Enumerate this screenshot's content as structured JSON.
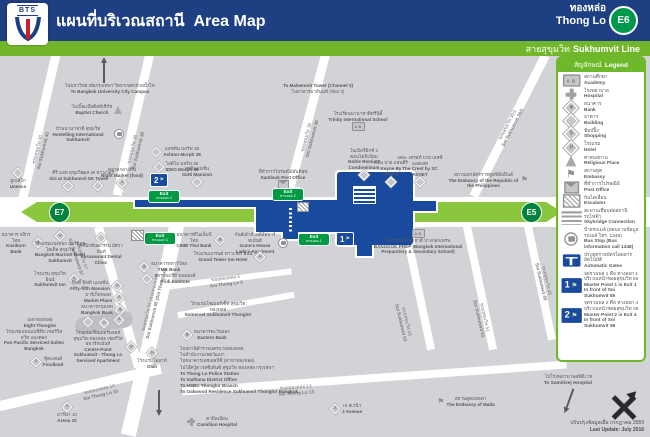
{
  "header": {
    "logo": "BTS",
    "title_th": "แผนที่บริเวณสถานี",
    "title_en": "Area Map",
    "station_th": "ทองหล่อ",
    "station_en": "Thong Lo",
    "code": "E6",
    "line_th": "สายสุขุมวิท",
    "line_en": "Sukhumvit Line"
  },
  "colors": {
    "navy": "#1e3f82",
    "green": "#72b62c",
    "road_green": "#8bc63f",
    "station_blue": "#1a4a9e",
    "exit_green": "#009a44"
  },
  "map": {
    "road": {
      "th": "ถนนสุขุมวิท",
      "en": "Sukhumvit Rd.",
      "left": "E7",
      "right": "E5"
    },
    "exit_word_en": "Exit",
    "exit_word_th": "ทางออก",
    "exits": [
      {
        "n": "1",
        "x": 298,
        "y": 233
      },
      {
        "n": "2",
        "x": 272,
        "y": 188
      },
      {
        "n": "3",
        "x": 144,
        "y": 232
      },
      {
        "n": "4",
        "x": 148,
        "y": 190
      }
    ],
    "musters": [
      {
        "n": "1",
        "x": 336,
        "y": 232
      },
      {
        "n": "2",
        "x": 150,
        "y": 173
      }
    ],
    "places": [
      {
        "x": 110,
        "y": 83,
        "w": 104,
        "icon": "",
        "ipos": "",
        "th": "ไปมหาวิทยาลัยกรุงเทพฯ วิทยาเขตกล้วยน้ำไท",
        "en": "To Bangkok University City Campus"
      },
      {
        "x": 318,
        "y": 83,
        "w": 112,
        "icon": "",
        "ipos": "",
        "ef": true,
        "th": "ไปอาคารมาลีนนท์ (ช่อง 3)",
        "en": "To Maleenont Tower (Channel 3)"
      },
      {
        "x": 97,
        "y": 104,
        "w": 74,
        "icon": "religious",
        "ipos": "r",
        "th": "ไบเบิ้ลแบ๊พติสท์เชิร์ช",
        "en": "Baptist Church"
      },
      {
        "x": 84,
        "y": 126,
        "w": 80,
        "icon": "busstop",
        "ipos": "r",
        "th": "บ้านนานาชาติ สุขุมวิท",
        "en": "Hostelling International Sukhumvit"
      },
      {
        "x": 122,
        "y": 167,
        "w": 56,
        "icon": "shopping",
        "ipos": "b",
        "th": "ตลาดกลางคืน",
        "en": "Night Market (food)"
      },
      {
        "x": 176,
        "y": 146,
        "w": 64,
        "icon": "building",
        "ipos": "l",
        "th": "แอชตัน มอร์ฟ 38",
        "en": "Ashton Morph 38"
      },
      {
        "x": 176,
        "y": 161,
        "w": 64,
        "icon": "building",
        "ipos": "l",
        "th": "ไอดีโอ มอร์ฟ 38",
        "en": "IDEO Morph 38"
      },
      {
        "x": 197,
        "y": 166,
        "w": 52,
        "icon": "building",
        "ipos": "b",
        "th": "สุทธิแมนชั่น",
        "en": "Sutti Mansion"
      },
      {
        "x": 18,
        "y": 168,
        "w": 42,
        "icon": "building",
        "ipos": "t",
        "th": "ยูเนสโก",
        "en": "Unesco"
      },
      {
        "x": 68,
        "y": 170,
        "w": 46,
        "icon": "building",
        "ipos": "b",
        "th": "ศิริ แอท สุขุมวิท",
        "en": "Siri at Sukhumvit"
      },
      {
        "x": 98,
        "y": 170,
        "w": 38,
        "icon": "building",
        "ipos": "b",
        "th": "เอส เค ทาวเวอร์",
        "en": "SK Tower"
      },
      {
        "x": 283,
        "y": 169,
        "w": 68,
        "icon": "post",
        "ipos": "b",
        "th": "ที่ทำการไปรษณีย์สันติสุข",
        "en": "Santisuk Post Office"
      },
      {
        "x": 364,
        "y": 148,
        "w": 50,
        "icon": "building",
        "ipos": "b",
        "th": "โนเบิลรีมิกซ์ 2 คอนโดมิเนียม",
        "en": "Noble Remix 2 Condominium"
      },
      {
        "x": 391,
        "y": 160,
        "w": 36,
        "icon": "building",
        "ipos": "b",
        "th": "คีย์น บาย แสนสิริ",
        "en": "Keyne By Sansiri"
      },
      {
        "x": 420,
        "y": 155,
        "w": 46,
        "icon": "building",
        "ipos": "b",
        "th": "เดอะ เครสท์ บาย เอสซี แอสเสท",
        "en": "The Crest by SC ASSET"
      },
      {
        "x": 358,
        "y": 111,
        "w": 84,
        "icon": "academy",
        "ipos": "b",
        "th": "โรงเรียนนานาชาติทรินิตี้",
        "en": "Trinity International School"
      },
      {
        "x": 488,
        "y": 172,
        "w": 80,
        "icon": "embassy",
        "ipos": "r",
        "th": "สถานเอกอัครราชทูตฟิลิปปินส์",
        "en": "The Embassy of the Republic of the Philippines"
      },
      {
        "x": 22,
        "y": 232,
        "w": 42,
        "icon": "bank",
        "ipos": "r",
        "th": "ธนาคาร กสิกรไทย",
        "en": "Kasikorn Bank"
      },
      {
        "x": 60,
        "y": 231,
        "w": 54,
        "icon": "hotel",
        "ipos": "t",
        "th": "โรงแรมแบงค็อก แมริออท โฮเต็ล สุขุมวิท",
        "en": "Bangkok Marriott Hotel Sukhumvit"
      },
      {
        "x": 101,
        "y": 233,
        "w": 50,
        "icon": "building",
        "ipos": "t",
        "th": "คลินิกทันตกรรม อัศวานันท์",
        "en": "Assavanant Dental Clinic"
      },
      {
        "x": 200,
        "y": 232,
        "w": 50,
        "icon": "bank",
        "ipos": "r",
        "th": "ธนาคารซีไอเอ็มบี ไทย",
        "en": "CIMB Thai Bank"
      },
      {
        "x": 261,
        "y": 232,
        "w": 54,
        "icon": "busstop",
        "ipos": "r",
        "th": "กันส์เฮ้าส์ เลดี้ส์อพาร์ทเม้นท์",
        "en": "Gunn's House Lady's Apartment"
      },
      {
        "x": 229,
        "y": 251,
        "w": 84,
        "icon": "hotel",
        "ipos": "r",
        "th": "โรงแรมแกรนด์ ทาวเวอร์ อินน์",
        "en": "Grand Tower Inn Hotel"
      },
      {
        "x": 163,
        "y": 261,
        "w": 52,
        "icon": "bank",
        "ipos": "l",
        "th": "ธนาคารทหารไทย",
        "en": "TMB Bank"
      },
      {
        "x": 169,
        "y": 273,
        "w": 58,
        "icon": "building",
        "ipos": "l",
        "th": "สถาบันปรีดี พนมยงค์",
        "en": "Pridi Institute"
      },
      {
        "x": 56,
        "y": 271,
        "w": 46,
        "icon": "hotel",
        "ipos": "r",
        "th": "โรงแรม สุขุมวิท อินน์",
        "en": "Sukhumvit Inn"
      },
      {
        "x": 96,
        "y": 280,
        "w": 56,
        "icon": "hotel",
        "ipos": "r",
        "th": "ฟิฟตี้ ฟิฟท์ แมนชั่น",
        "en": "Fifty-fifth Mansion"
      },
      {
        "x": 104,
        "y": 292,
        "w": 46,
        "icon": "shopping",
        "ipos": "r",
        "th": "มาร์เก็ตเพลส",
        "en": "Market Place"
      },
      {
        "x": 103,
        "y": 304,
        "w": 46,
        "icon": "bank",
        "ipos": "r",
        "th": "ธนาคารกรุงเทพ",
        "en": "Bangkok Bank"
      },
      {
        "x": 40,
        "y": 317,
        "w": 48,
        "icon": "",
        "ipos": "",
        "th": "เอท ทองหล่อ",
        "en": "Eight Thonglor"
      },
      {
        "x": 34,
        "y": 329,
        "w": 64,
        "icon": "",
        "ipos": "",
        "th": "โรงแรมแพนแปซิฟิก เซอร์วิส สวีท แบงคอก",
        "en": "Pan Pacific Serviced Suites Bangkok"
      },
      {
        "x": 47,
        "y": 356,
        "w": 42,
        "icon": "shopping",
        "ipos": "l",
        "th": "ฟู้ดแลนด์",
        "en": "Foodland"
      },
      {
        "x": 104,
        "y": 330,
        "w": 64,
        "icon": "hotel",
        "ipos": "r",
        "th": "โรงแรมเซ็นเตอร์พอยท์ สุขุมวิท-ทองหล่อ เซอร์วิส อพาร์ทเม้นท์",
        "en": "Centre Point Sukhumvit - Thong Lo Serviced Apartment"
      },
      {
        "x": 152,
        "y": 348,
        "w": 42,
        "icon": "hotel",
        "ipos": "t",
        "th": "โรงแรมโอลาห์",
        "en": "Olah"
      },
      {
        "x": 218,
        "y": 301,
        "w": 70,
        "icon": "",
        "ipos": "",
        "th": "โรงแรมโซเมอร์เซ็ท สุขุมวิท ทองหล่อ",
        "en": "Somerset Sukhumvit Thonglor"
      },
      {
        "x": 206,
        "y": 329,
        "w": 58,
        "icon": "bank",
        "ipos": "l",
        "th": "ธนาคารตะวันออก",
        "en": "Eastern Bank"
      },
      {
        "x": 418,
        "y": 229,
        "w": 112,
        "icon": "academy",
        "ipos": "t",
        "th": "โรงเรียนนานาชาติ บางกอกเพรพ",
        "en": "BANGKOK PREP (Bangkok International Preparatory & Secondary School)"
      },
      {
        "x": 346,
        "y": 403,
        "w": 42,
        "icon": "shopping",
        "ipos": "l",
        "th": "เจ อเวนิว",
        "en": "J Avenue"
      },
      {
        "x": 212,
        "y": 416,
        "w": 52,
        "icon": "hospital",
        "ipos": "l",
        "th": "คามิลเลี่ยน",
        "en": "Camillian Hospital"
      },
      {
        "x": 67,
        "y": 402,
        "w": 38,
        "icon": "shopping",
        "ipos": "t",
        "th": "อารีน่า 10",
        "en": "Arena 10"
      },
      {
        "x": 466,
        "y": 396,
        "w": 64,
        "icon": "embassy",
        "ipos": "l",
        "th": "สถานทูตมอลตา",
        "en": "The Embassy of Malta"
      },
      {
        "x": 88,
        "y": 317,
        "w": 8,
        "icon": "building",
        "ipos": "only",
        "th": "",
        "en": ""
      },
      {
        "x": 104,
        "y": 318,
        "w": 8,
        "icon": "hotel",
        "ipos": "only",
        "th": "",
        "en": ""
      },
      {
        "x": 119,
        "y": 315,
        "w": 8,
        "icon": "shopping",
        "ipos": "only",
        "th": "",
        "en": ""
      }
    ],
    "streets": [
      {
        "x": 40,
        "y": 150,
        "rot": -76,
        "th": "ซอยสุขุมวิท 40",
        "en": "Soi Sukhumvit 40"
      },
      {
        "x": 135,
        "y": 150,
        "rot": -76,
        "th": "ซอยสุขุมวิท 38",
        "en": "Soi Sukhumvit 38"
      },
      {
        "x": 309,
        "y": 138,
        "rot": -75,
        "th": "ซอยสุขุมวิท 36",
        "en": "Soi Sukhumvit 36"
      },
      {
        "x": 510,
        "y": 126,
        "rot": -62,
        "th": "ซอยสุขุมวิท 30/1",
        "en": "Soi Sukhumvit 30/1"
      },
      {
        "x": 79,
        "y": 256,
        "rot": 72,
        "th": "ซอยสุขุมวิท 57",
        "en": "Soi Sukhumvit 57"
      },
      {
        "x": 153,
        "y": 303,
        "rot": -76,
        "th": "ซอยสุขุมวิท 55 (ซอยทองหล่อ)",
        "en": "Soi Sukhumvit 55 (Soi Thong Lo)"
      },
      {
        "x": 226,
        "y": 281,
        "rot": -7,
        "th": "ซอยทองหล่อ 5",
        "en": "Soi Thong Lo 5"
      },
      {
        "x": 100,
        "y": 392,
        "rot": -13,
        "th": "ซอยทองหล่อ 10",
        "en": "Soi Thong Lo 10"
      },
      {
        "x": 296,
        "y": 390,
        "rot": -4,
        "th": "ซอยทองหล่อ 13",
        "en": "Soi Thong Lo 13"
      },
      {
        "x": 404,
        "y": 322,
        "rot": 77,
        "th": "ซอยสุขุมวิท 53",
        "en": "Soi Sukhumvit 53"
      },
      {
        "x": 482,
        "y": 318,
        "rot": 77,
        "th": "ซอยสุขุมวิท 51",
        "en": "Soi Sukhumvit 51"
      },
      {
        "x": 544,
        "y": 281,
        "rot": 77,
        "th": "ซอยสุขุมวิท 49",
        "en": "Soi Sukhumvit 49"
      }
    ],
    "directions": {
      "th": [
        "ไปสถานีตำรวจนครบาลทองหล่อ",
        "ไปสำนักงานเขตวัฒนา",
        "ไปธนาคารเอชเอสบีซี (สาขาทองหล่อ)",
        "ไปโอ๊ควู้ด เรสซิเด้นซ์ สุขุมวิท ทองหล่อ กรุงเทพฯ"
      ],
      "en": [
        "To Thong Lo Police Station",
        "To Vadhana District Office",
        "To HSBC Thonglor Branch",
        "To Oakwood Residence Sukhumvit Thonglor Bangkok"
      ]
    }
  },
  "legend": {
    "title_th": "สัญลักษณ์",
    "title_en": "Legend",
    "items": [
      {
        "icon": "academy",
        "th": "สถานศึกษา",
        "en": "Academy"
      },
      {
        "icon": "hospital",
        "th": "โรงพยาบาล",
        "en": "Hospital"
      },
      {
        "icon": "bank",
        "th": "ธนาคาร",
        "en": "Bank"
      },
      {
        "icon": "building",
        "th": "อาคาร",
        "en": "Building"
      },
      {
        "icon": "shopping",
        "th": "ช้อปปิ้ง",
        "en": "Shopping"
      },
      {
        "icon": "hotel",
        "th": "โรงแรม",
        "en": "Hotel"
      },
      {
        "icon": "religious",
        "th": "ศาสนสถาน",
        "en": "Religious Place"
      },
      {
        "icon": "embassy",
        "th": "สถานทูต",
        "en": "Embassy"
      },
      {
        "icon": "post",
        "th": "ที่ทำการไปรษณีย์",
        "en": "Post Office"
      },
      {
        "icon": "escalator",
        "th": "บันไดเลื่อน",
        "en": "Escalator"
      },
      {
        "icon": "skybridge",
        "th": "สะพานเชื่อมต่อสถานีรถไฟฟ้า",
        "en": "Skybridge Connection"
      },
      {
        "icon": "busstop",
        "th": "ป้ายรถเมล์ (สอบถามข้อมูลรถเมล์ โทร. 1348)",
        "en": "Bus Stop (Bus information call 1348)"
      },
      {
        "icon": "gates",
        "th": "ประตูตรวจบัตรโดยสารอัตโนมัติ",
        "en": "Automatic Gates"
      },
      {
        "icon": "muster",
        "num": "1",
        "th": "จุดรวมพล 1 คือ ทางออก 1 บริเวณหน้าซอยสุขุมวิท 55",
        "en": "Muster Point 1 is Exit 1 In front of Soi Sukhumvit 55"
      },
      {
        "icon": "muster",
        "num": "2",
        "th": "จุดรวมพล 2 คือ ทางออก 4 บริเวณหน้าซอยสุขุมวิท 38",
        "en": "Muster Point 2 is Exit 4 In front of Soi Sukhumvit 38"
      }
    ]
  },
  "footer": {
    "update_th": "ปรับปรุงข้อมูลเมื่อ กรกฎาคม 2559",
    "update_en": "Last Update: July 2016",
    "samitivej_th": "ไปโรงพยาบาลสมิติเวช",
    "samitivej_en": "To Samitivej Hospital"
  }
}
